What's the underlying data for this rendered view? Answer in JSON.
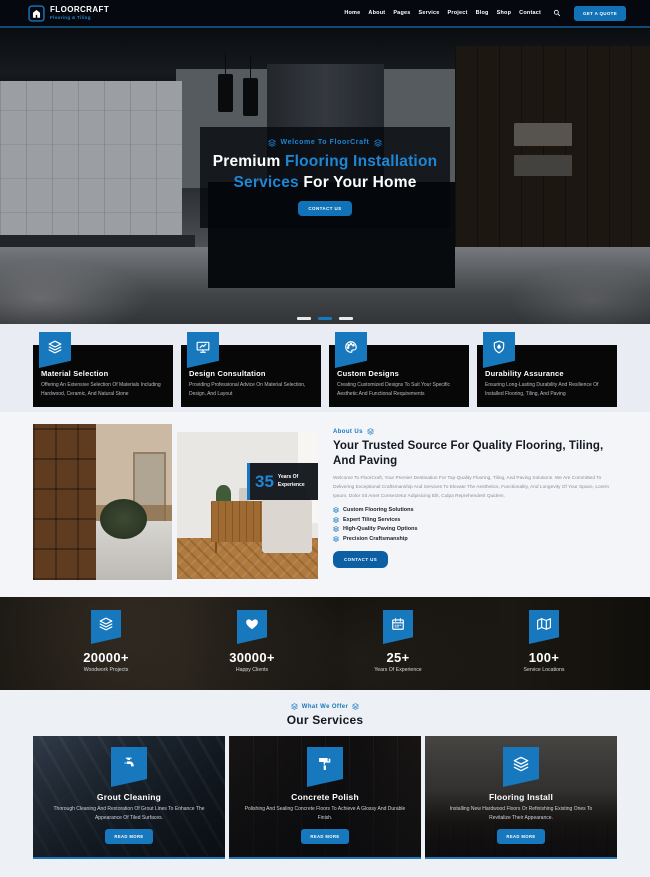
{
  "colors": {
    "accent": "#1778be",
    "accent_text": "#1e86d4",
    "header_bg": "#05090f",
    "card_bg": "#070707"
  },
  "brand": {
    "name": "FLOORCRAFT",
    "tagline": "Flooring & Tiling"
  },
  "nav": {
    "items": [
      "Home",
      "About",
      "Pages",
      "Service",
      "Project",
      "Blog",
      "Shop",
      "Contact"
    ],
    "cta": "GET A QUOTE"
  },
  "hero": {
    "welcome": "Welcome To FloorCraft",
    "title_line1_white": "Premium",
    "title_line1_blue": "Flooring Installation",
    "title_line2_blue": "Services",
    "title_line2_white": "For Your Home",
    "cta": "CONTACT US",
    "slider_active_index": 1
  },
  "features": [
    {
      "icon": "layers-icon",
      "title": "Material Selection",
      "desc": "Offering An Extensive Selection Of Materials Including Hardwood, Ceramic, And Natural Stone"
    },
    {
      "icon": "presentation-icon",
      "title": "Design Consultation",
      "desc": "Providing Professional Advice On Material Selection, Design, And Layout"
    },
    {
      "icon": "palette-icon",
      "title": "Custom Designs",
      "desc": "Creating Customized Designs To Suit Your Specific Aesthetic And Functional Requirements"
    },
    {
      "icon": "shield-icon",
      "title": "Durability Assurance",
      "desc": "Ensuring Long-Lasting Durability And Resilience Of Installed Flooring, Tiling, And Paving"
    }
  ],
  "about": {
    "kicker": "About Us",
    "heading": "Your Trusted Source For Quality Flooring, Tiling, And Paving",
    "paragraph": "Welcome To FloorCraft, Your Premier Destination For Top-Quality Flooring, Tiling, And Paving Solutions. We Are Committed To Delivering Exceptional Craftsmanship And Services To Elevate The Aesthetics, Functionality, And Longevity Of Your Space, Lorem Ipsum, Dolor Sit Amet Consectetur Adipisicing Elit, Culpa Reprehenderit Quidem.",
    "bullets": [
      "Custom Flooring Solutions",
      "Expert Tiling Services",
      "High-Quality Paving Options",
      "Precision Craftsmanship"
    ],
    "badge": {
      "number": "35",
      "label": "Years Of Experience"
    },
    "cta": "CONTACT US"
  },
  "stats": [
    {
      "icon": "layers-icon",
      "value": "20000+",
      "label": "Woodwork Projects"
    },
    {
      "icon": "heart-icon",
      "value": "30000+",
      "label": "Happy Clients"
    },
    {
      "icon": "calendar-icon",
      "value": "25+",
      "label": "Years Of Experience"
    },
    {
      "icon": "map-icon",
      "value": "100+",
      "label": "Service Locations"
    }
  ],
  "services": {
    "kicker": "What We Offer",
    "heading": "Our Services",
    "cards": [
      {
        "icon": "faucet-icon",
        "title": "Grout Cleaning",
        "desc": "Thorough Cleaning And Restoration Of Grout Lines To Enhance The Appearance Of Tiled Surfaces.",
        "cta": "READ MORE"
      },
      {
        "icon": "paint-roller-icon",
        "title": "Concrete Polish",
        "desc": "Polishing And Sealing Concrete Floors To Achieve A Glossy And Durable Finish.",
        "cta": "READ MORE"
      },
      {
        "icon": "layers-icon",
        "title": "Flooring Install",
        "desc": "Installing New Hardwood Floors Or Refinishing Existing Ones To Revitalize Their Appearance.",
        "cta": "READ MORE"
      }
    ]
  }
}
